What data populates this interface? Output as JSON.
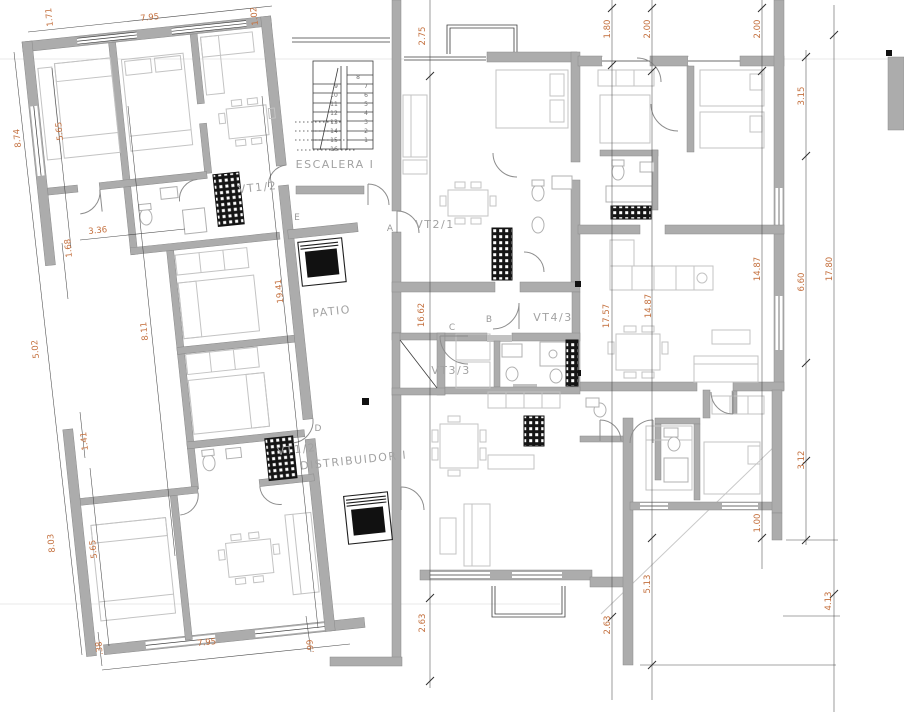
{
  "drawing_type": "architectural floor plan",
  "colors": {
    "dimension_text": "#c4703e",
    "walls": "#acacac",
    "room_labels": "#a2a2a2"
  },
  "rooms": {
    "escalera": "ESCALERA I",
    "patio": "PATIO",
    "distribuidor": "DISTRIBUIDOR I",
    "vt12_upper": "VT1/2",
    "vt12_lower": "VT1/2",
    "vt21": "VT2/1",
    "vt43": "VT4/3",
    "vt33": "VT3/3"
  },
  "door_letters": {
    "a": "A",
    "b": "B",
    "c": "C",
    "d": "D",
    "e": "E"
  },
  "stair": {
    "right": [
      "8",
      "7",
      "6",
      "5",
      "4",
      "3",
      "2",
      "1"
    ],
    "left": [
      "9",
      "10",
      "11",
      "12",
      "13",
      "14",
      "15",
      "16"
    ]
  },
  "dims": {
    "t171": "1.71",
    "t795": "7.95",
    "t102": "1.02",
    "t275": "2.75",
    "t180": "1.80",
    "t200a": "2.00",
    "t200b": "2.00",
    "r315": "3.15",
    "r1487a": "14.87",
    "r660": "6.60",
    "r1780": "17.80",
    "r100": "1.00",
    "r312": "3.12",
    "r413": "4.13",
    "m1662": "16.62",
    "m1757": "17.57",
    "m1487b": "14.87",
    "m513": "5.13",
    "m263a": "2.63",
    "m263b": "2.63",
    "l874": "8.74",
    "l565a": "5.65",
    "l336": "3.36",
    "l168": "1.68",
    "l502": "5.02",
    "l811": "8.11",
    "l1941": "19.41",
    "l141": "1.41",
    "l803": "8.03",
    "l565b": "5.65",
    "b795": "7.95",
    "b038": ".38",
    "b099": ".99"
  }
}
